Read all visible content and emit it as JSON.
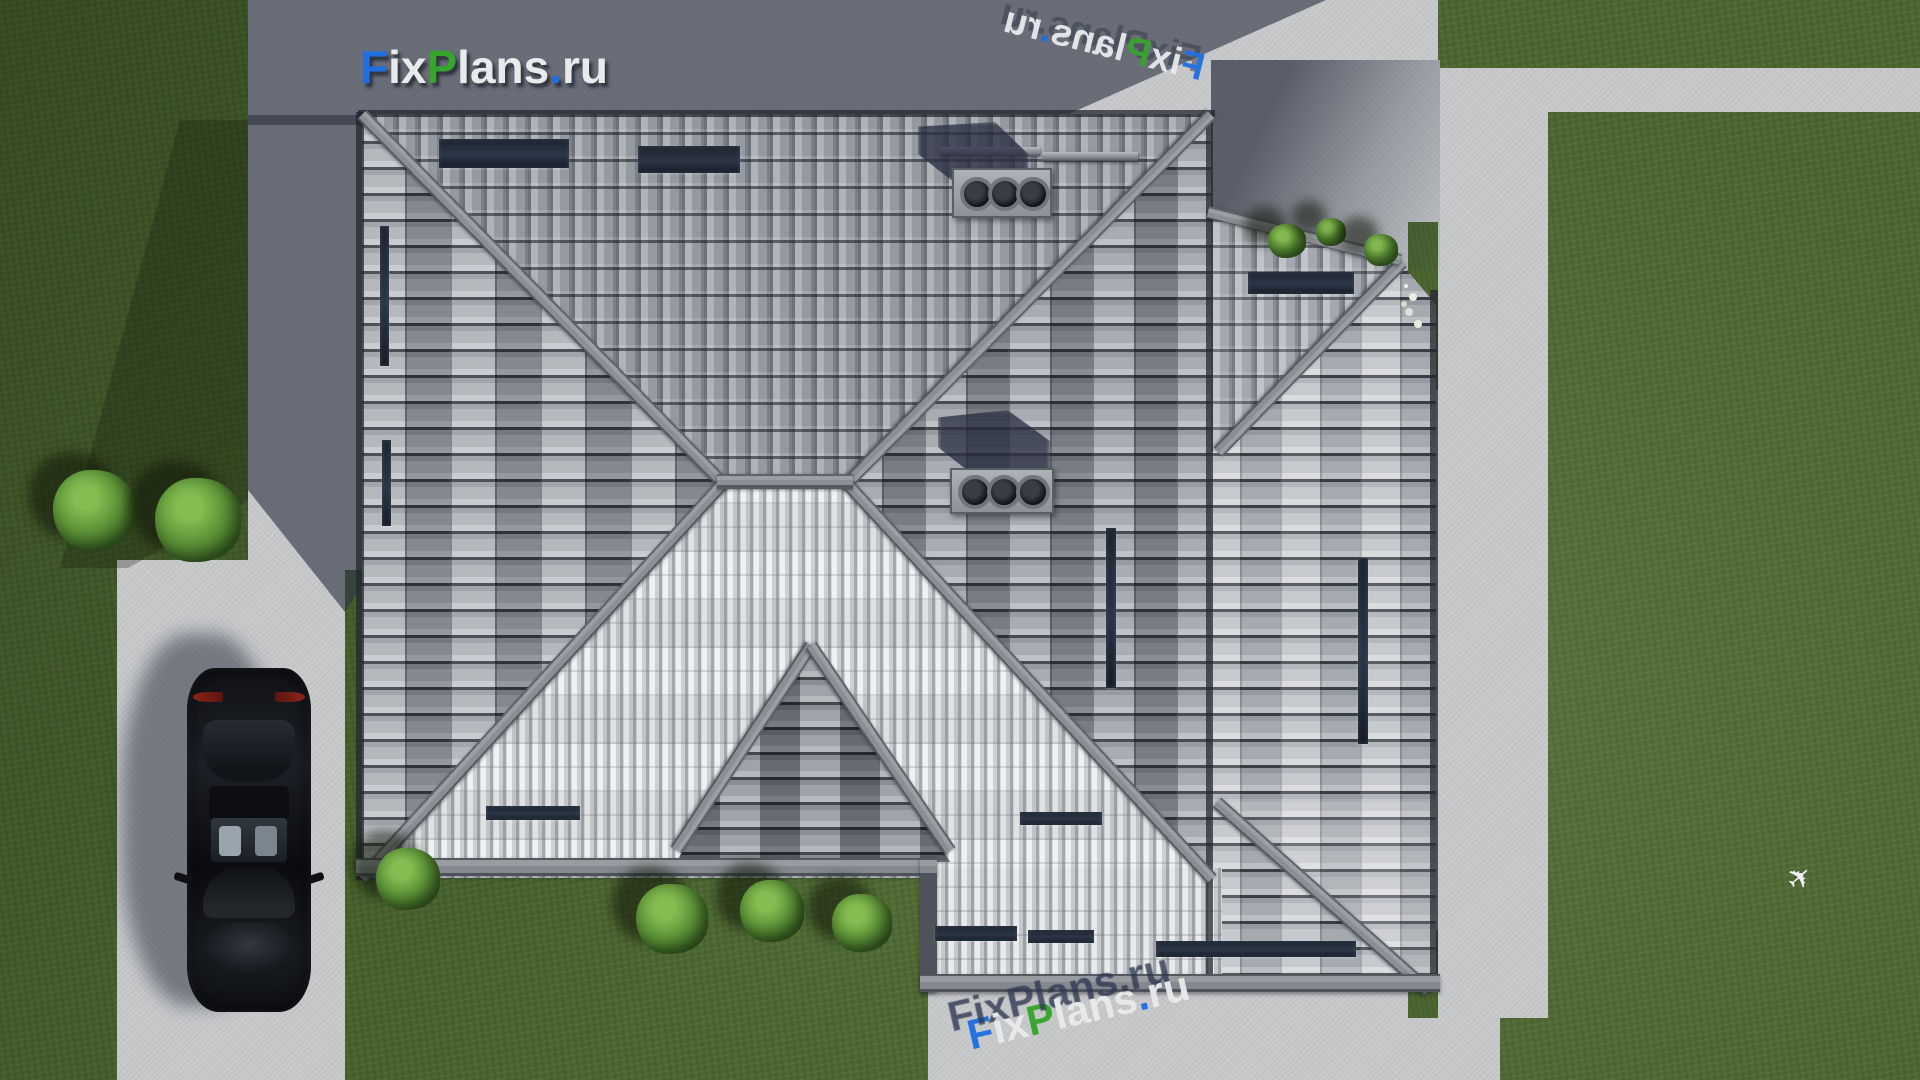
{
  "brand": {
    "full_text": "FixPlans.ru",
    "segments": [
      {
        "text": "F",
        "color": "#1f6fe0"
      },
      {
        "text": "ix",
        "color": "#e9eaec"
      },
      {
        "text": "P",
        "color": "#35a52c"
      },
      {
        "text": "lans",
        "color": "#e9eaec"
      },
      {
        "text": ".",
        "color": "#1f6fe0"
      },
      {
        "text": "ru",
        "color": "#e9eaec"
      }
    ]
  },
  "palette": {
    "grass": "#4c6730",
    "pavement": "#c6c8ca",
    "cast_shadow": "#474d5c",
    "ridge_gray": "#94979c",
    "tile_bright": "#e9eaec",
    "tile_mid": "#9ba0a6",
    "tile_dark": "#2e323b",
    "car_body": "#14161a",
    "bush_green": "#4f7d33",
    "logo_blue": "#1f6fe0",
    "logo_green": "#35a52c",
    "logo_white": "#e9eaec"
  },
  "scene": {
    "view": "top-down 3D render of hip-roof house",
    "objects": [
      "tiled hip roof",
      "two chimneys with three pipes",
      "snow-guard rails",
      "roof windows",
      "driveway with parked car",
      "garden paths",
      "lawn with bushes",
      "white flowers",
      "small airplane glyph"
    ]
  }
}
